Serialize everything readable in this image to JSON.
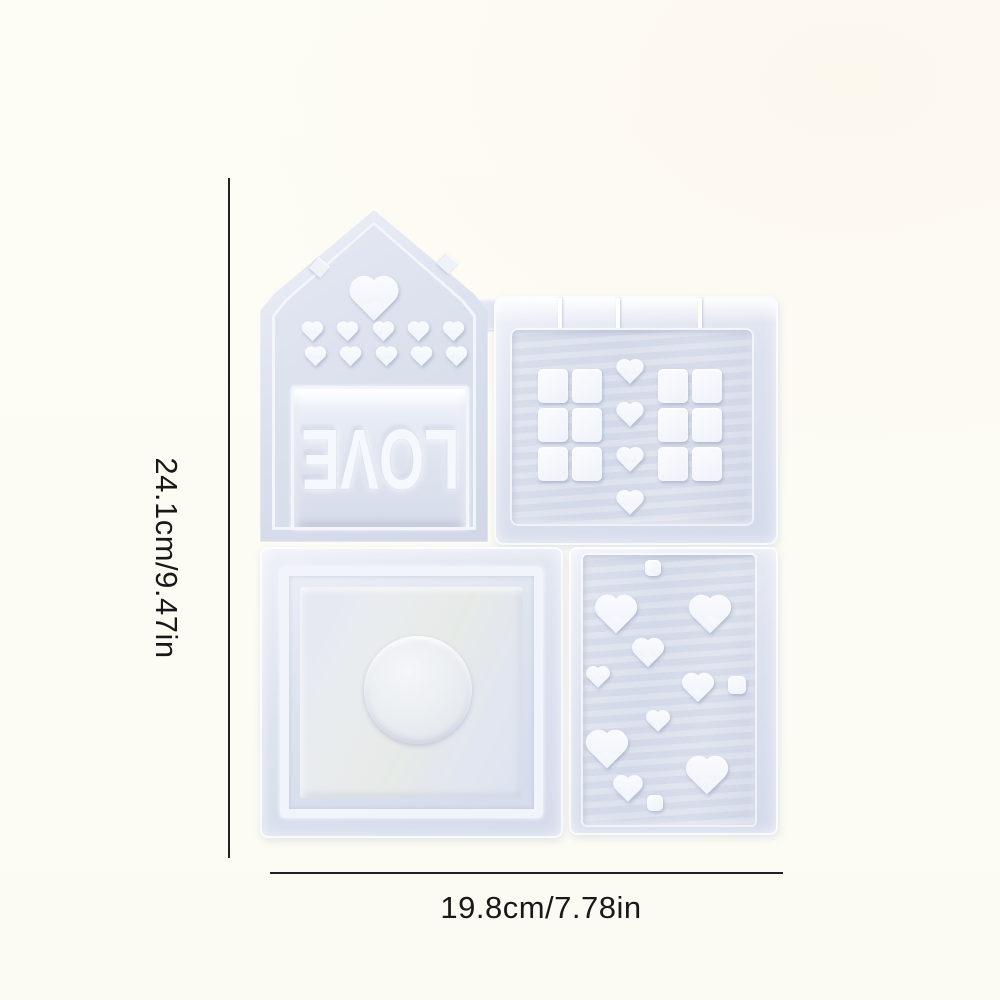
{
  "dimensions": {
    "height_label": "24.1cm/9.47in",
    "width_label": "19.8cm/7.78in"
  },
  "mold": {
    "love_text": "LOVE",
    "sections": [
      {
        "id": "house-love-mold",
        "shapes": [
          {
            "type": "heart",
            "x": 116,
            "y": 80,
            "s": 46
          },
          {
            "type": "heart",
            "x": 54,
            "y": 117,
            "s": 21
          },
          {
            "type": "heart",
            "x": 89,
            "y": 117,
            "s": 21
          },
          {
            "type": "heart",
            "x": 125,
            "y": 117,
            "s": 21
          },
          {
            "type": "heart",
            "x": 160,
            "y": 117,
            "s": 21
          },
          {
            "type": "heart",
            "x": 195,
            "y": 117,
            "s": 21
          },
          {
            "type": "heart",
            "x": 57,
            "y": 142,
            "s": 21
          },
          {
            "type": "heart",
            "x": 92,
            "y": 142,
            "s": 21
          },
          {
            "type": "heart",
            "x": 128,
            "y": 142,
            "s": 21
          },
          {
            "type": "heart",
            "x": 163,
            "y": 142,
            "s": 21
          },
          {
            "type": "heart",
            "x": 198,
            "y": 142,
            "s": 21
          }
        ]
      },
      {
        "id": "cubes-hearts-mold",
        "shapes": [
          {
            "type": "square",
            "x": 59,
            "y": 90,
            "w": 30,
            "h": 34
          },
          {
            "type": "square",
            "x": 93,
            "y": 90,
            "w": 30,
            "h": 34
          },
          {
            "type": "square",
            "x": 59,
            "y": 129,
            "w": 30,
            "h": 34
          },
          {
            "type": "square",
            "x": 93,
            "y": 129,
            "w": 30,
            "h": 34
          },
          {
            "type": "square",
            "x": 59,
            "y": 168,
            "w": 30,
            "h": 34
          },
          {
            "type": "square",
            "x": 93,
            "y": 168,
            "w": 30,
            "h": 34
          },
          {
            "type": "square",
            "x": 179,
            "y": 90,
            "w": 30,
            "h": 34
          },
          {
            "type": "square",
            "x": 213,
            "y": 90,
            "w": 30,
            "h": 34
          },
          {
            "type": "square",
            "x": 179,
            "y": 129,
            "w": 30,
            "h": 34
          },
          {
            "type": "square",
            "x": 213,
            "y": 129,
            "w": 30,
            "h": 34
          },
          {
            "type": "square",
            "x": 179,
            "y": 168,
            "w": 30,
            "h": 34
          },
          {
            "type": "square",
            "x": 213,
            "y": 168,
            "w": 30,
            "h": 34
          },
          {
            "type": "heart",
            "x": 136,
            "y": 71,
            "s": 26
          },
          {
            "type": "heart",
            "x": 136,
            "y": 114,
            "s": 26
          },
          {
            "type": "heart",
            "x": 136,
            "y": 159,
            "s": 26
          },
          {
            "type": "heart",
            "x": 136,
            "y": 202,
            "s": 26
          }
        ]
      },
      {
        "id": "coaster-circle-mold",
        "shapes": [
          {
            "type": "circle",
            "x": 158,
            "y": 143,
            "s": 108
          }
        ]
      },
      {
        "id": "hearts-scatter-mold",
        "shapes": [
          {
            "type": "square",
            "x": 84,
            "y": 21,
            "s": 16
          },
          {
            "type": "heart",
            "x": 47,
            "y": 60,
            "s": 40
          },
          {
            "type": "heart",
            "x": 141,
            "y": 60,
            "s": 40
          },
          {
            "type": "heart",
            "x": 79,
            "y": 100,
            "s": 30
          },
          {
            "type": "heart",
            "x": 29,
            "y": 126,
            "s": 22
          },
          {
            "type": "heart",
            "x": 129,
            "y": 135,
            "s": 30
          },
          {
            "type": "square",
            "x": 168,
            "y": 138,
            "s": 18
          },
          {
            "type": "heart",
            "x": 89,
            "y": 170,
            "s": 22
          },
          {
            "type": "heart",
            "x": 38,
            "y": 195,
            "s": 40
          },
          {
            "type": "heart",
            "x": 138,
            "y": 221,
            "s": 40
          },
          {
            "type": "heart",
            "x": 59,
            "y": 237,
            "s": 28
          },
          {
            "type": "square",
            "x": 86,
            "y": 256,
            "s": 16
          }
        ]
      }
    ]
  },
  "colors": {
    "background": "#fdfcf5",
    "mold_body": "#dde2ef",
    "cavity_white": "#f7f9fd",
    "dimension_line": "#222222",
    "label_text": "#181818"
  }
}
